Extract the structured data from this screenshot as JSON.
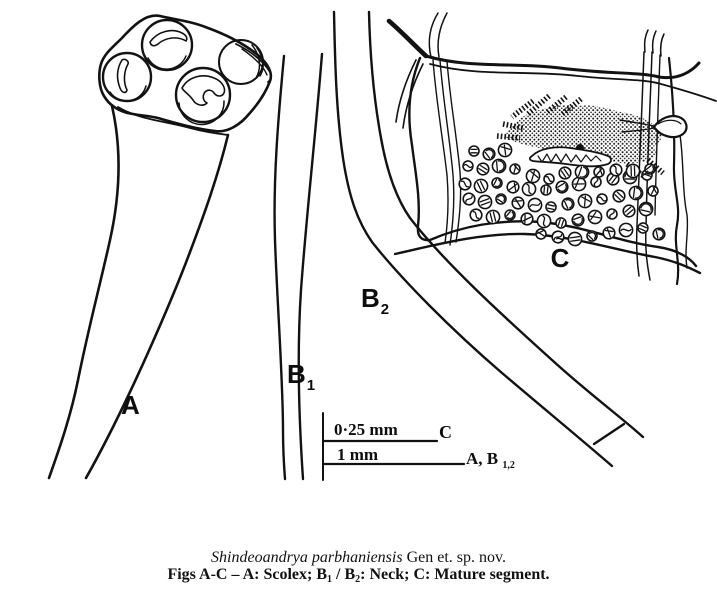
{
  "figure": {
    "labels": {
      "a": "A",
      "b1_base": "B",
      "b1_sub": "1",
      "b2_base": "B",
      "b2_sub": "2",
      "c": "C",
      "c_tilde": "~"
    },
    "scale_bars": {
      "top_label": "0·25 mm",
      "top_ref": "C",
      "bottom_label": "1 mm",
      "bottom_ref_base": "A, B ",
      "bottom_ref_sub": "1,2"
    },
    "caption": {
      "species_italic": "Shindeoandrya parbhaniensis",
      "species_rest": " Gen et. sp. nov.",
      "line2_prefix": "Figs A-C – A: Scolex; B",
      "line2_sub1": "1",
      "line2_mid": " / B",
      "line2_sub2": "2",
      "line2_suffix": ": Neck; C: Mature segment."
    }
  },
  "colors": {
    "ink": "#121212",
    "background": "#ffffff"
  }
}
